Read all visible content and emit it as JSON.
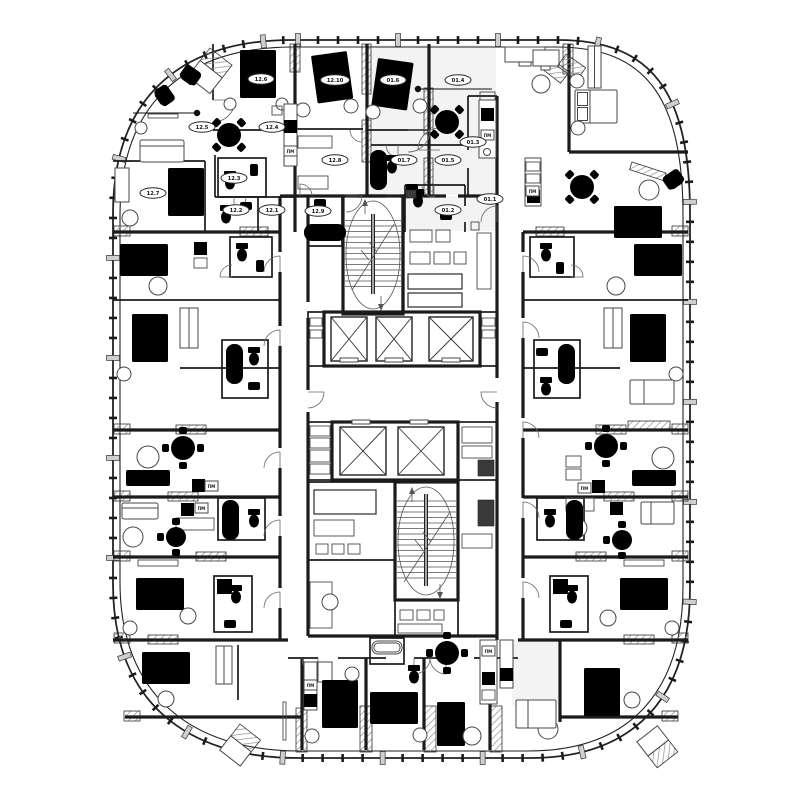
{
  "plan": {
    "background": "#ffffff",
    "line_color": "#1b1b1b",
    "hatch_color": "#999999",
    "washer_label": "ПМ",
    "units": [
      {
        "id": "12.5",
        "x": 202,
        "y": 127
      },
      {
        "id": "12.6",
        "x": 261,
        "y": 79
      },
      {
        "id": "12.10",
        "x": 335,
        "y": 80
      },
      {
        "id": "01.6",
        "x": 393,
        "y": 80
      },
      {
        "id": "01.4",
        "x": 458,
        "y": 80
      },
      {
        "id": "12.4",
        "x": 272,
        "y": 127
      },
      {
        "id": "12.8",
        "x": 335,
        "y": 160
      },
      {
        "id": "01.7",
        "x": 404,
        "y": 160
      },
      {
        "id": "01.5",
        "x": 448,
        "y": 160
      },
      {
        "id": "01.3",
        "x": 473,
        "y": 142
      },
      {
        "id": "12.3",
        "x": 234,
        "y": 178
      },
      {
        "id": "12.7",
        "x": 153,
        "y": 193
      },
      {
        "id": "12.2",
        "x": 236,
        "y": 210
      },
      {
        "id": "12.1",
        "x": 272,
        "y": 210
      },
      {
        "id": "12.9",
        "x": 318,
        "y": 211
      },
      {
        "id": "01.2",
        "x": 448,
        "y": 210
      },
      {
        "id": "01.1",
        "x": 490,
        "y": 199
      }
    ]
  }
}
